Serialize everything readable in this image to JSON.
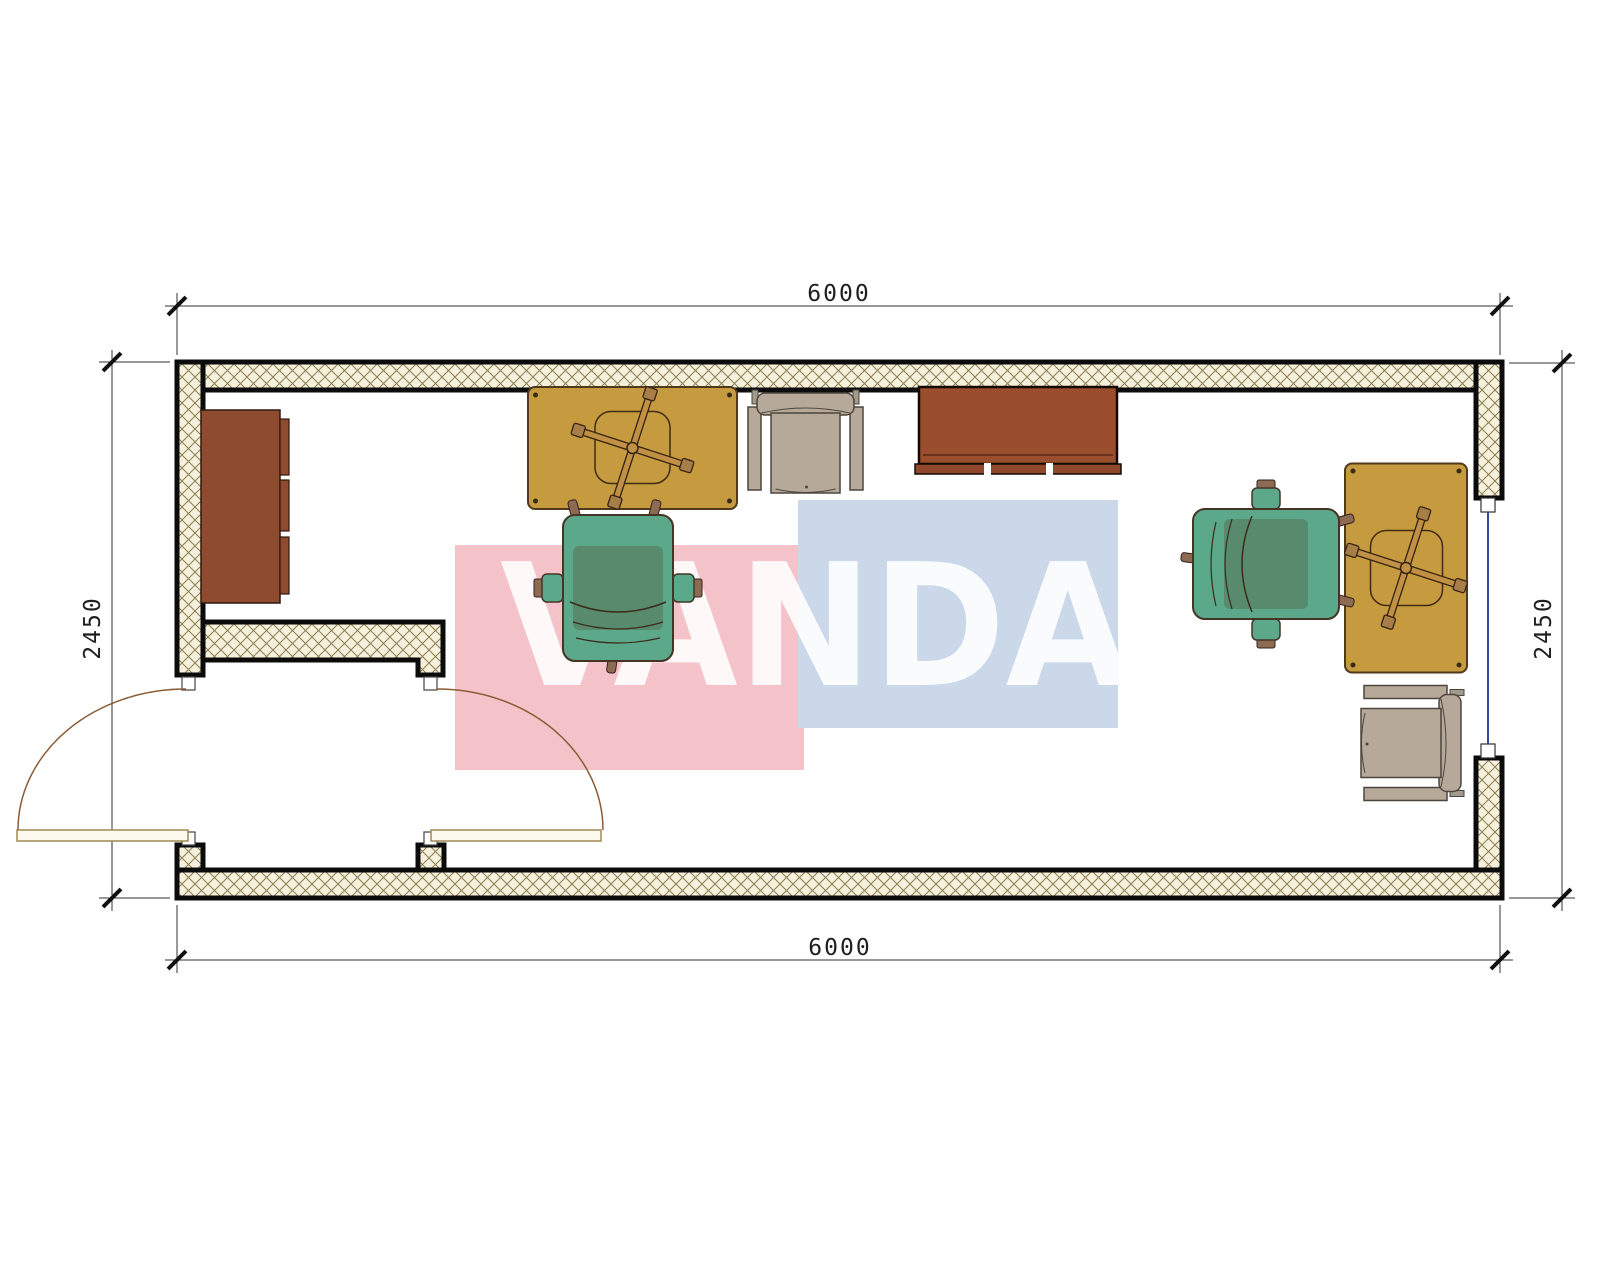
{
  "watermark": {
    "text": "VANDA",
    "pink_block_color": "#F4C3CA",
    "blue_block_color": "#CBD8EA",
    "text_color": "#FFFFFF"
  },
  "dimensions": {
    "top": "6000",
    "bottom": "6000",
    "left": "2450",
    "right": "2450"
  },
  "plan": {
    "type": "floor-plan",
    "room_width_mm": "6000",
    "room_depth_mm": "2450",
    "wall_hatch_background": "#F6F1DC",
    "wall_hatch_line": "#8C7D52",
    "wall_edge_color": "#0B0B0B",
    "window_line_color": "#2F4A9B",
    "door_leaf_color": "#FCF9EF",
    "door_arc_color": "#8A5C34",
    "furniture_icons": [
      {
        "name": "sideboard-cabinet-icon",
        "color": "#8E4B2D"
      },
      {
        "name": "desk-top-center-icon",
        "color": "#C69A3E"
      },
      {
        "name": "task-chair-base-icon",
        "color": "#C19045"
      },
      {
        "name": "visitor-armchair-top-icon",
        "color": "#B7A99A"
      },
      {
        "name": "credenza-desk-icon",
        "color": "#9A4E2D"
      },
      {
        "name": "office-chair-center-icon",
        "color": "#5BA88B"
      },
      {
        "name": "office-chair-right-icon",
        "color": "#5BA88B"
      },
      {
        "name": "desk-right-icon",
        "color": "#C69A3E"
      },
      {
        "name": "visitor-armchair-bottom-right-icon",
        "color": "#B7A99A"
      }
    ]
  }
}
